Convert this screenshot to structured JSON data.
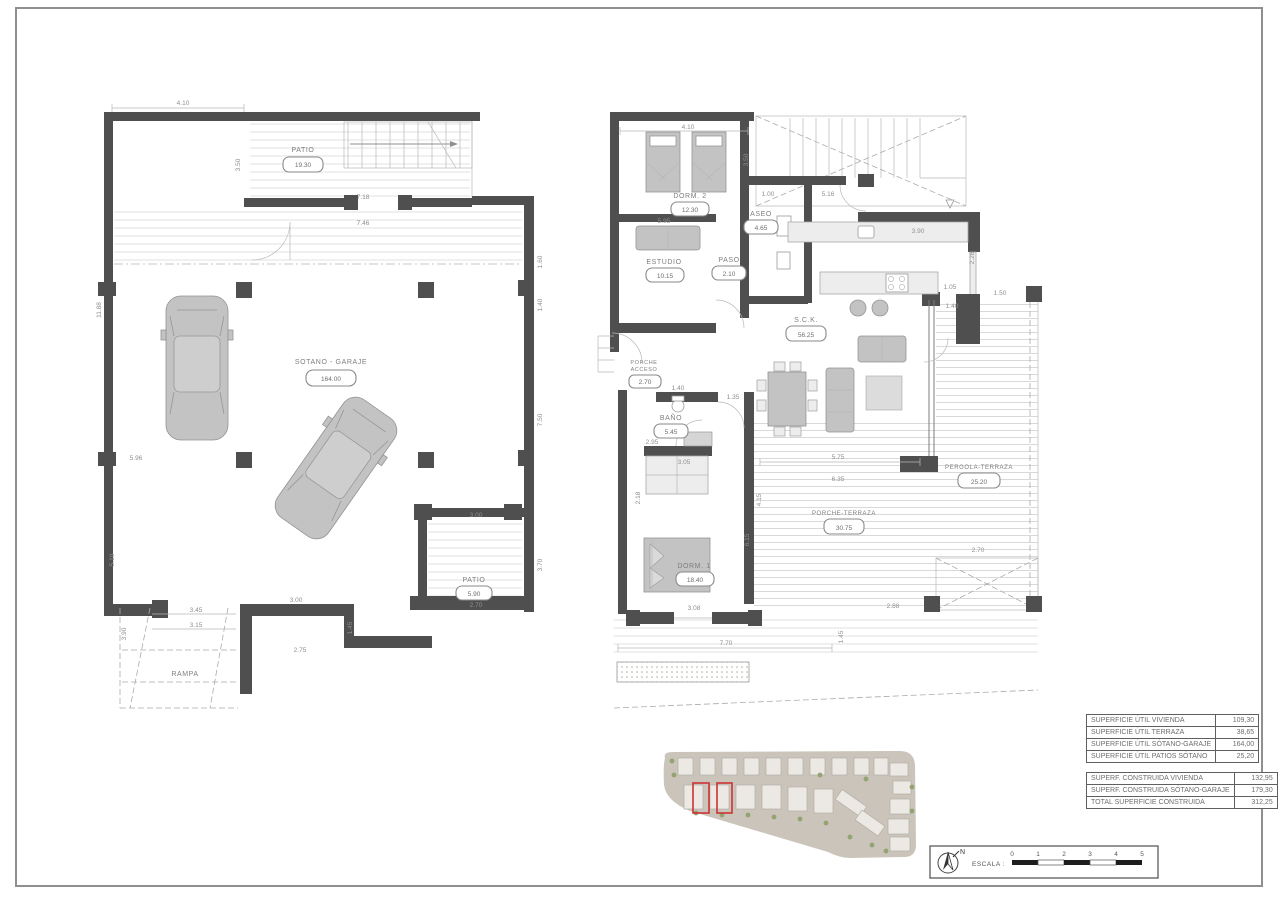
{
  "left_plan": {
    "rooms": {
      "patio_top": {
        "label": "PATIO",
        "area": "19.30"
      },
      "garage": {
        "label": "SOTANO - GARAJE",
        "area": "164.00"
      },
      "patio_bottom": {
        "label": "PATIO",
        "area": "5.90"
      },
      "rampa": {
        "label": "RAMPA"
      }
    },
    "dims": [
      "4.10",
      "3.50",
      "7.18",
      "7.46",
      "11.88",
      "1.60",
      "1.40",
      "7.50",
      "3.70",
      "5.96",
      "5.10",
      "3.90",
      "3.45",
      "3.15",
      "2.75",
      "1.45",
      "3.00",
      "2.70",
      "3.00"
    ]
  },
  "right_plan": {
    "rooms": {
      "dorm2": {
        "label": "DORM. 2",
        "area": "12.30"
      },
      "aseo": {
        "label": "ASEO",
        "area": "4.65"
      },
      "estudio": {
        "label": "ESTUDIO",
        "area": "10.15"
      },
      "paso": {
        "label": "PASO",
        "area": "2.10"
      },
      "porche_acceso": {
        "label": "PORCHE",
        "label2": "ACCESO",
        "area": "2.70"
      },
      "sck": {
        "label": "S.C.K.",
        "area": "56.25"
      },
      "bano": {
        "label": "BAÑO",
        "area": "5.45"
      },
      "dorm1": {
        "label": "DORM. 1",
        "area": "18.40"
      },
      "porche_terraza": {
        "label": "PORCHE-TERRAZA",
        "area": "30.75"
      },
      "pergola_terraza": {
        "label": "PERGOLA-TERRAZA",
        "area": "25.20"
      }
    },
    "dims": [
      "4.10",
      "1.00",
      "5.16",
      "5.95",
      "3.90",
      "1.05",
      "1.50",
      "1.40",
      "1.35",
      "1.40",
      "2.95",
      "3.05",
      "2.18",
      "3.08",
      "7.70",
      "1.45",
      "5.75",
      "6.35",
      "2.70",
      "2.88",
      "6.15",
      "4.15",
      "2.28",
      "3.50"
    ]
  },
  "tables": {
    "util": [
      {
        "label": "SUPERFICIE ÚTIL VIVIENDA",
        "value": "109,30"
      },
      {
        "label": "SUPERFICIE ÚTIL TERRAZA",
        "value": "38,65"
      },
      {
        "label": "SUPERFICIE ÚTIL SÓTANO-GARAJE",
        "value": "164,00"
      },
      {
        "label": "SUPERFICIE ÚTIL PATIOS SÓTANO",
        "value": "25,20"
      }
    ],
    "construida": [
      {
        "label": "SUPERF. CONSTRUIDA VIVIENDA",
        "value": "132,95"
      },
      {
        "label": "SUPERF. CONSTRUIDA SÓTANO-GARAJE",
        "value": "179,30"
      },
      {
        "label": "TOTAL SUPERFICIE CONSTRUIDA",
        "value": "312,25"
      }
    ]
  },
  "footer": {
    "north_label": "N",
    "scale_label": "ESCALA :",
    "scale_ticks": [
      "0",
      "1",
      "2",
      "3",
      "4",
      "5"
    ]
  },
  "colors": {
    "wall": "#4f4f4f",
    "highlight_red": "#cc3333",
    "site_background": "#cac4bb",
    "hatch": "#dedede"
  }
}
